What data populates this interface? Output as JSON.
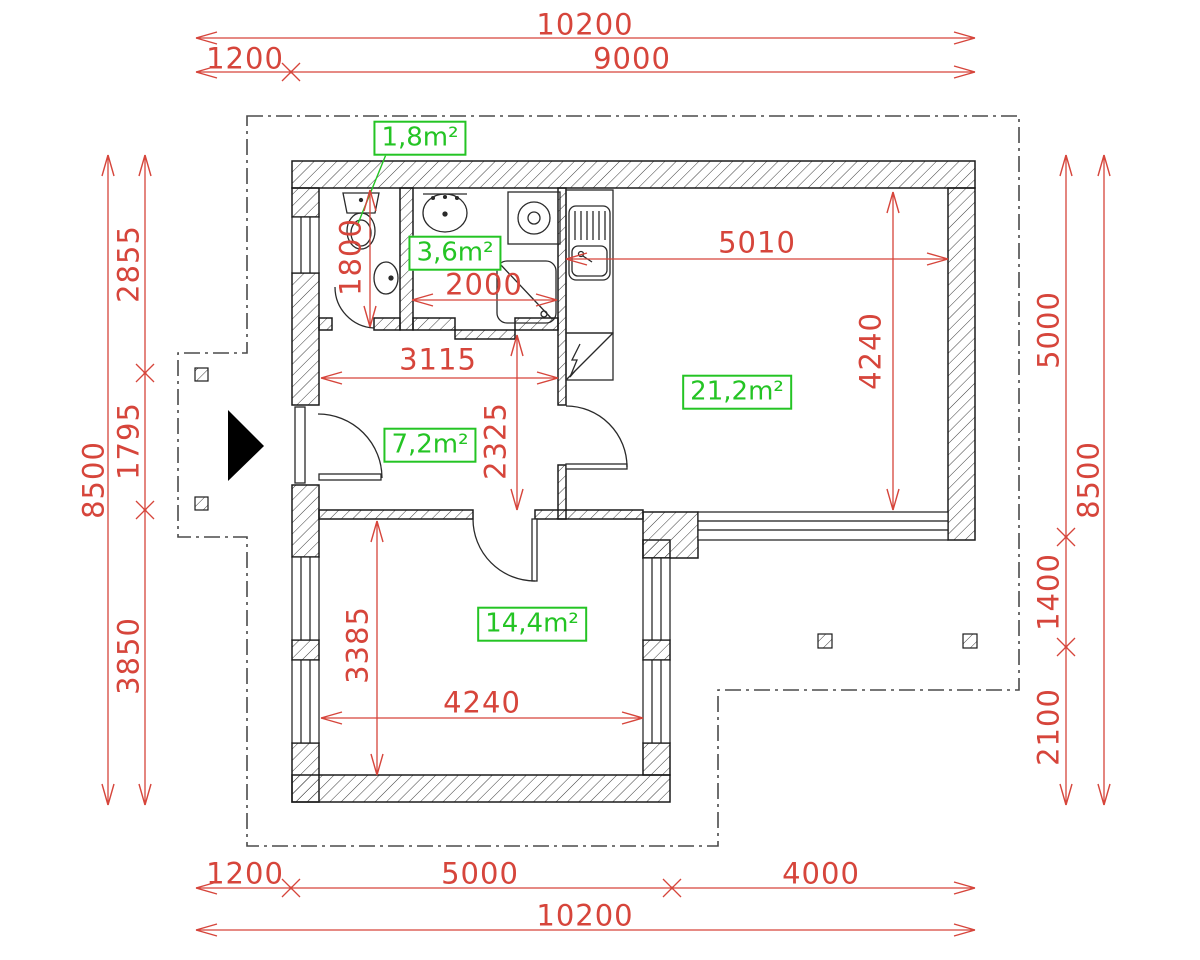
{
  "drawing": {
    "type": "apartment floor plan",
    "units": "mm"
  },
  "colors": {
    "dimension_red": "#d6453b",
    "area_green": "#24c424",
    "wall_black": "#1b1b1b",
    "boundary_gray": "#4a4a4a"
  },
  "dims": {
    "top_total": "10200",
    "top_1200": "1200",
    "top_9000": "9000",
    "bottom_1200": "1200",
    "bottom_5000": "5000",
    "bottom_4000": "4000",
    "bottom_total": "10200",
    "left_total": "8500",
    "left_2855": "2855",
    "left_1795": "1795",
    "left_3850": "3850",
    "right_total": "8500",
    "right_5000": "5000",
    "right_1400": "1400",
    "right_2100": "2100",
    "wc_1800": "1800",
    "bath_2000": "2000",
    "kitchen_5010": "5010",
    "living_4240": "4240",
    "hall_3115": "3115",
    "hall_2325": "2325",
    "bedroom_3385": "3385",
    "bedroom_4240": "4240"
  },
  "areas": {
    "wc": "1,8m²",
    "bathroom": "3,6m²",
    "living": "21,2m²",
    "hall": "7,2m²",
    "bedroom": "14,4m²"
  }
}
